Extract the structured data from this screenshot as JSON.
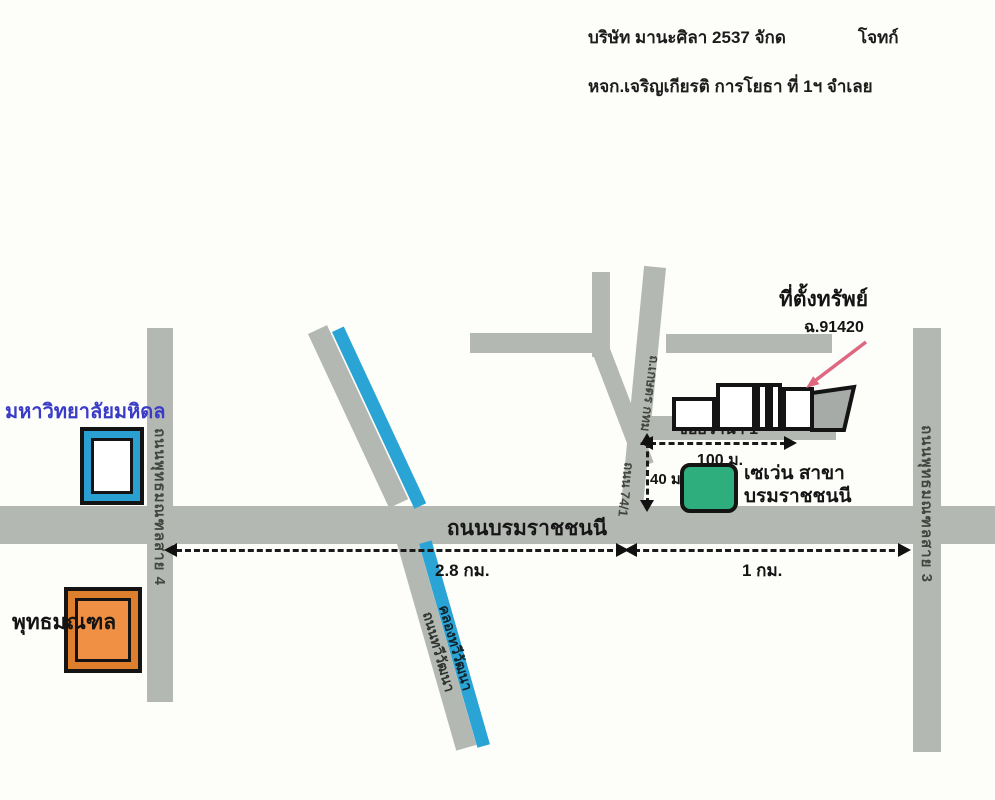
{
  "header": {
    "line1_left": "บริษัท มานะศิลา 2537 จักด",
    "line1_right": "โจทก์",
    "line2": "หจก.เจริญเกียรติ การโยธา ที่ 1ฯ จำเลย"
  },
  "roads": {
    "main": "ถนนบรมราชชนนี",
    "sai4": "ถนนพุทธมณฑลสาย 4",
    "sai3": "ถนนพุทธมณฑลสาย 3",
    "soi_wana": "ซอยวานา 1",
    "access_upper": "ถ.เกษตร กทม",
    "access_lower": "ถนน 74/1",
    "thawi_road": "ถนนทวีวัฒนา",
    "thawi_canal": "คลองทวีวัฒนา"
  },
  "landmarks": {
    "university": "มหาวิทยาลัยมหิดล",
    "park": "พุทธมณฑล",
    "seven_line1": "เซเว่น สาขา",
    "seven_line2": "บรมราชชนนี",
    "property_title": "ที่ตั้งทรัพย์",
    "property_deed": "ฉ.91420"
  },
  "distances": {
    "soi": "100 ม.",
    "depth": "40 ม.",
    "west": "2.8 กม.",
    "east": "1 กม."
  },
  "colors": {
    "road_gray": "#b4b8b2",
    "canal_blue": "#2aa4d4",
    "seven_green": "#2fae7d",
    "park_orange_dark": "#de7f2d",
    "park_orange": "#f09045",
    "university_blue": "#2aa0d2",
    "university_text_blue": "#3a3cc8",
    "pointer_pink": "#dd6880",
    "property_fill_gray": "#a7aba7"
  }
}
